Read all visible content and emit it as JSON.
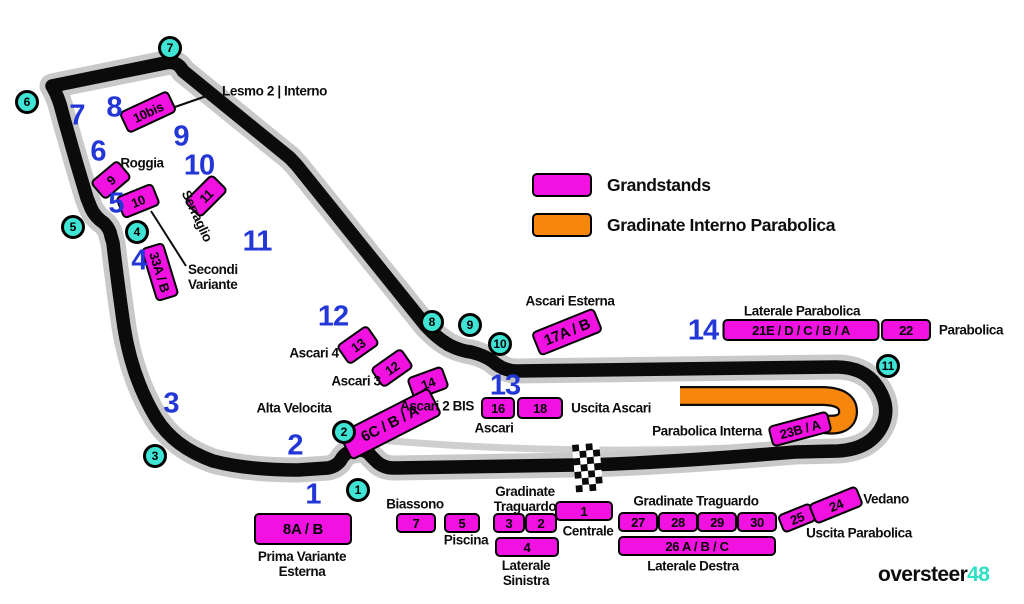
{
  "map": {
    "title": "Monza circuit grandstand map",
    "colors": {
      "grandstand_magenta": "#F112E2",
      "gradinate_orange": "#F7860D",
      "turn_marker_cyan": "#3FE4D4",
      "section_number_blue": "#2336D6",
      "track_black": "#0b0b0b",
      "track_casing_gray": "#c9c9c9",
      "watermark_accent": "#2FE0C4"
    },
    "legend": {
      "items": [
        {
          "label": "Grandstands",
          "color": "#F112E2"
        },
        {
          "label": "Gradinate Interno Parabolica",
          "color": "#F7860D"
        }
      ]
    },
    "watermark": {
      "brand": "oversteer",
      "suffix": "48"
    },
    "turn_markers": [
      {
        "n": "1",
        "x": 358,
        "y": 490
      },
      {
        "n": "2",
        "x": 344,
        "y": 432
      },
      {
        "n": "3",
        "x": 155,
        "y": 456
      },
      {
        "n": "4",
        "x": 137,
        "y": 232
      },
      {
        "n": "5",
        "x": 73,
        "y": 227
      },
      {
        "n": "6",
        "x": 27,
        "y": 102
      },
      {
        "n": "7",
        "x": 170,
        "y": 48
      },
      {
        "n": "8",
        "x": 432,
        "y": 322
      },
      {
        "n": "9",
        "x": 470,
        "y": 325
      },
      {
        "n": "10",
        "x": 500,
        "y": 344
      },
      {
        "n": "11",
        "x": 888,
        "y": 366
      }
    ],
    "section_numbers": [
      {
        "n": "1",
        "x": 313,
        "y": 495
      },
      {
        "n": "2",
        "x": 295,
        "y": 446
      },
      {
        "n": "3",
        "x": 171,
        "y": 404
      },
      {
        "n": "4",
        "x": 139,
        "y": 261
      },
      {
        "n": "5",
        "x": 116,
        "y": 204
      },
      {
        "n": "6",
        "x": 98,
        "y": 152
      },
      {
        "n": "7",
        "x": 77,
        "y": 116
      },
      {
        "n": "8",
        "x": 114,
        "y": 108
      },
      {
        "n": "9",
        "x": 181,
        "y": 137
      },
      {
        "n": "10",
        "x": 199,
        "y": 166
      },
      {
        "n": "11",
        "x": 257,
        "y": 242
      },
      {
        "n": "12",
        "x": 333,
        "y": 317
      },
      {
        "n": "13",
        "x": 505,
        "y": 386
      },
      {
        "n": "14",
        "x": 703,
        "y": 331
      }
    ],
    "grandstands": [
      {
        "label": "10bis",
        "x": 148,
        "y": 112,
        "w": 54,
        "h": 24,
        "rot": -25
      },
      {
        "label": "9",
        "x": 111,
        "y": 180,
        "w": 36,
        "h": 24,
        "rot": -40
      },
      {
        "label": "10",
        "x": 138,
        "y": 201,
        "w": 40,
        "h": 24,
        "rot": -22
      },
      {
        "label": "11",
        "x": 206,
        "y": 196,
        "w": 40,
        "h": 24,
        "rot": -45
      },
      {
        "label": "33A / B",
        "x": 160,
        "y": 272,
        "w": 56,
        "h": 24,
        "rot": 73
      },
      {
        "label": "13",
        "x": 358,
        "y": 345,
        "w": 38,
        "h": 24,
        "rot": -35
      },
      {
        "label": "12",
        "x": 392,
        "y": 368,
        "w": 38,
        "h": 24,
        "rot": -35
      },
      {
        "label": "14",
        "x": 428,
        "y": 383,
        "w": 38,
        "h": 24,
        "rot": -20
      },
      {
        "label": "6C / B / A",
        "x": 390,
        "y": 424,
        "w": 102,
        "h": 31,
        "rot": -27
      },
      {
        "label": "16",
        "x": 498,
        "y": 408,
        "w": 34,
        "h": 22,
        "rot": 0
      },
      {
        "label": "18",
        "x": 540,
        "y": 408,
        "w": 46,
        "h": 22,
        "rot": 0
      },
      {
        "label": "17A / B",
        "x": 567,
        "y": 332,
        "w": 68,
        "h": 26,
        "rot": -22
      },
      {
        "label": "21E / D / C / B / A",
        "x": 801,
        "y": 330,
        "w": 157,
        "h": 22,
        "rot": 0
      },
      {
        "label": "22",
        "x": 906,
        "y": 330,
        "w": 50,
        "h": 22,
        "rot": 0
      },
      {
        "label": "23B / A",
        "x": 800,
        "y": 429,
        "w": 62,
        "h": 22,
        "rot": -15
      },
      {
        "label": "8A / B",
        "x": 303,
        "y": 529,
        "w": 98,
        "h": 32,
        "rot": 0
      },
      {
        "label": "7",
        "x": 416,
        "y": 523,
        "w": 40,
        "h": 20,
        "rot": 0
      },
      {
        "label": "5",
        "x": 462,
        "y": 523,
        "w": 36,
        "h": 20,
        "rot": 0
      },
      {
        "label": "3",
        "x": 509,
        "y": 523,
        "w": 32,
        "h": 20,
        "rot": 0
      },
      {
        "label": "2",
        "x": 541,
        "y": 523,
        "w": 32,
        "h": 20,
        "rot": 0
      },
      {
        "label": "1",
        "x": 584,
        "y": 511,
        "w": 58,
        "h": 20,
        "rot": 0
      },
      {
        "label": "4",
        "x": 527,
        "y": 547,
        "w": 64,
        "h": 20,
        "rot": 0
      },
      {
        "label": "27",
        "x": 638,
        "y": 522,
        "w": 40,
        "h": 20,
        "rot": 0
      },
      {
        "label": "28",
        "x": 678,
        "y": 522,
        "w": 40,
        "h": 20,
        "rot": 0
      },
      {
        "label": "29",
        "x": 717,
        "y": 522,
        "w": 40,
        "h": 20,
        "rot": 0
      },
      {
        "label": "30",
        "x": 757,
        "y": 522,
        "w": 40,
        "h": 20,
        "rot": 0
      },
      {
        "label": "26 A / B / C",
        "x": 697,
        "y": 546,
        "w": 158,
        "h": 20,
        "rot": 0
      },
      {
        "label": "25",
        "x": 797,
        "y": 518,
        "w": 36,
        "h": 20,
        "rot": -22
      },
      {
        "label": "24",
        "x": 836,
        "y": 505,
        "w": 52,
        "h": 22,
        "rot": -22
      }
    ],
    "labels": [
      {
        "id": "lesmo-2-interno",
        "lines": [
          "Lesmo 2 | Interno"
        ],
        "x": 222,
        "y": 91,
        "align": "left",
        "rot": 0
      },
      {
        "id": "roggia",
        "lines": [
          "Roggia"
        ],
        "x": 142,
        "y": 163,
        "align": "center",
        "rot": 0
      },
      {
        "id": "serraglio",
        "lines": [
          "Serraglio"
        ],
        "x": 197,
        "y": 216,
        "align": "center",
        "rot": 65
      },
      {
        "id": "secondi-variante",
        "lines": [
          "Secondi",
          "Variante"
        ],
        "x": 188,
        "y": 277,
        "align": "left",
        "rot": 0
      },
      {
        "id": "ascari-4",
        "lines": [
          "Ascari 4"
        ],
        "x": 314,
        "y": 353,
        "align": "center",
        "rot": 0
      },
      {
        "id": "ascari-3",
        "lines": [
          "Ascari 3"
        ],
        "x": 356,
        "y": 381,
        "align": "center",
        "rot": 0
      },
      {
        "id": "ascari-2-bis",
        "lines": [
          "Ascari 2 BIS"
        ],
        "x": 437,
        "y": 406,
        "align": "center",
        "rot": 0
      },
      {
        "id": "alta-velocita",
        "lines": [
          "Alta Velocita"
        ],
        "x": 294,
        "y": 408,
        "align": "center",
        "rot": 0
      },
      {
        "id": "ascari",
        "lines": [
          "Ascari"
        ],
        "x": 494,
        "y": 428,
        "align": "center",
        "rot": 0
      },
      {
        "id": "uscita-ascari",
        "lines": [
          "Uscita Ascari"
        ],
        "x": 611,
        "y": 408,
        "align": "center",
        "rot": 0
      },
      {
        "id": "ascari-esterna",
        "lines": [
          "Ascari Esterna"
        ],
        "x": 570,
        "y": 301,
        "align": "center",
        "rot": 0
      },
      {
        "id": "laterale-parabolica",
        "lines": [
          "Laterale Parabolica"
        ],
        "x": 802,
        "y": 311,
        "align": "center",
        "rot": 0
      },
      {
        "id": "parabolica",
        "lines": [
          "Parabolica"
        ],
        "x": 971,
        "y": 330,
        "align": "center",
        "rot": 0
      },
      {
        "id": "parabolica-interna",
        "lines": [
          "Parabolica Interna"
        ],
        "x": 707,
        "y": 431,
        "align": "center",
        "rot": 0
      },
      {
        "id": "biassono",
        "lines": [
          "Biassono"
        ],
        "x": 415,
        "y": 504,
        "align": "center",
        "rot": 0
      },
      {
        "id": "piscina",
        "lines": [
          "Piscina"
        ],
        "x": 466,
        "y": 540,
        "align": "center",
        "rot": 0
      },
      {
        "id": "gradinate-traguardo-left",
        "lines": [
          "Gradinate",
          "Traguardo"
        ],
        "x": 525,
        "y": 499,
        "align": "center",
        "rot": 0
      },
      {
        "id": "centrale",
        "lines": [
          "Centrale"
        ],
        "x": 588,
        "y": 531,
        "align": "center",
        "rot": 0
      },
      {
        "id": "laterale-sinistra",
        "lines": [
          "Laterale",
          "Sinistra"
        ],
        "x": 526,
        "y": 573,
        "align": "center",
        "rot": 0
      },
      {
        "id": "gradinate-traguardo-right",
        "lines": [
          "Gradinate Traguardo"
        ],
        "x": 696,
        "y": 501,
        "align": "center",
        "rot": 0
      },
      {
        "id": "laterale-destra",
        "lines": [
          "Laterale Destra"
        ],
        "x": 693,
        "y": 566,
        "align": "center",
        "rot": 0
      },
      {
        "id": "vedano",
        "lines": [
          "Vedano"
        ],
        "x": 886,
        "y": 499,
        "align": "center",
        "rot": 0
      },
      {
        "id": "uscita-parabolica",
        "lines": [
          "Uscita Parabolica"
        ],
        "x": 859,
        "y": 533,
        "align": "center",
        "rot": 0
      },
      {
        "id": "prima-variante-esterna",
        "lines": [
          "Prima Variante",
          "Esterna"
        ],
        "x": 302,
        "y": 564,
        "align": "center",
        "rot": 0
      }
    ]
  }
}
